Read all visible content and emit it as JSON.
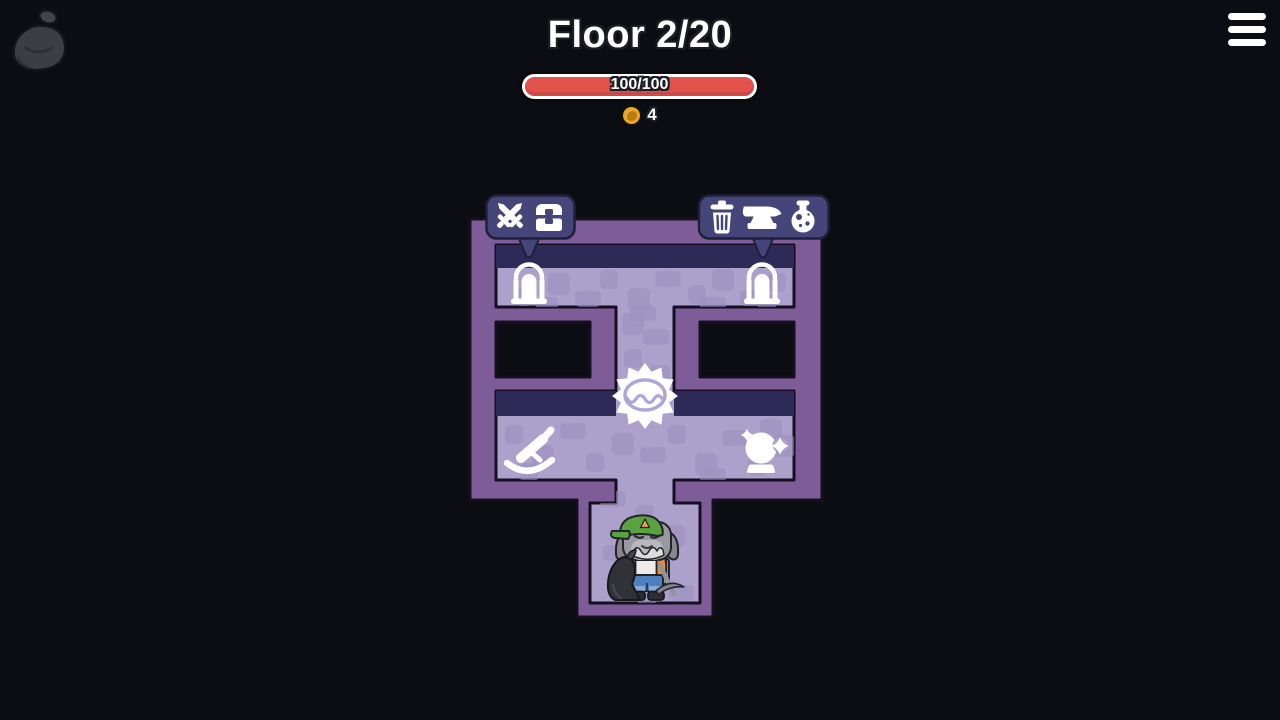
{
  "hud": {
    "floor_label": "Floor 2/20",
    "hp": {
      "current": 100,
      "max": 100,
      "display": "100/100"
    },
    "coins": 4,
    "loot_bag_icon": "loot-bag-icon",
    "menu_icon": "hamburger-menu-icon",
    "coin_icon": "coin-icon"
  },
  "map": {
    "tooltips": {
      "left": {
        "icons": [
          "crossed-swords-icon",
          "treasure-chest-icon"
        ]
      },
      "right": {
        "icons": [
          "trash-icon",
          "anvil-icon",
          "potion-icon"
        ]
      }
    },
    "markers": [
      "door-left",
      "door-right",
      "event-burst-marker",
      "rocking-horse-marker",
      "crystal-ball-marker",
      "player-miner-character"
    ]
  },
  "colors": {
    "background": "#0c0d12",
    "map_border": "#7d5c97",
    "map_floor": "#aba1cb",
    "map_tile": "#9a8fc0",
    "map_wall_band": "#2e2a57",
    "map_outline": "#150f20",
    "tooltip_bg": "#45457a",
    "tooltip_outline": "#20203a",
    "hp_fill": "#e4524d",
    "coin_gold": "#f2a41c",
    "icon_white": "#ffffff"
  }
}
